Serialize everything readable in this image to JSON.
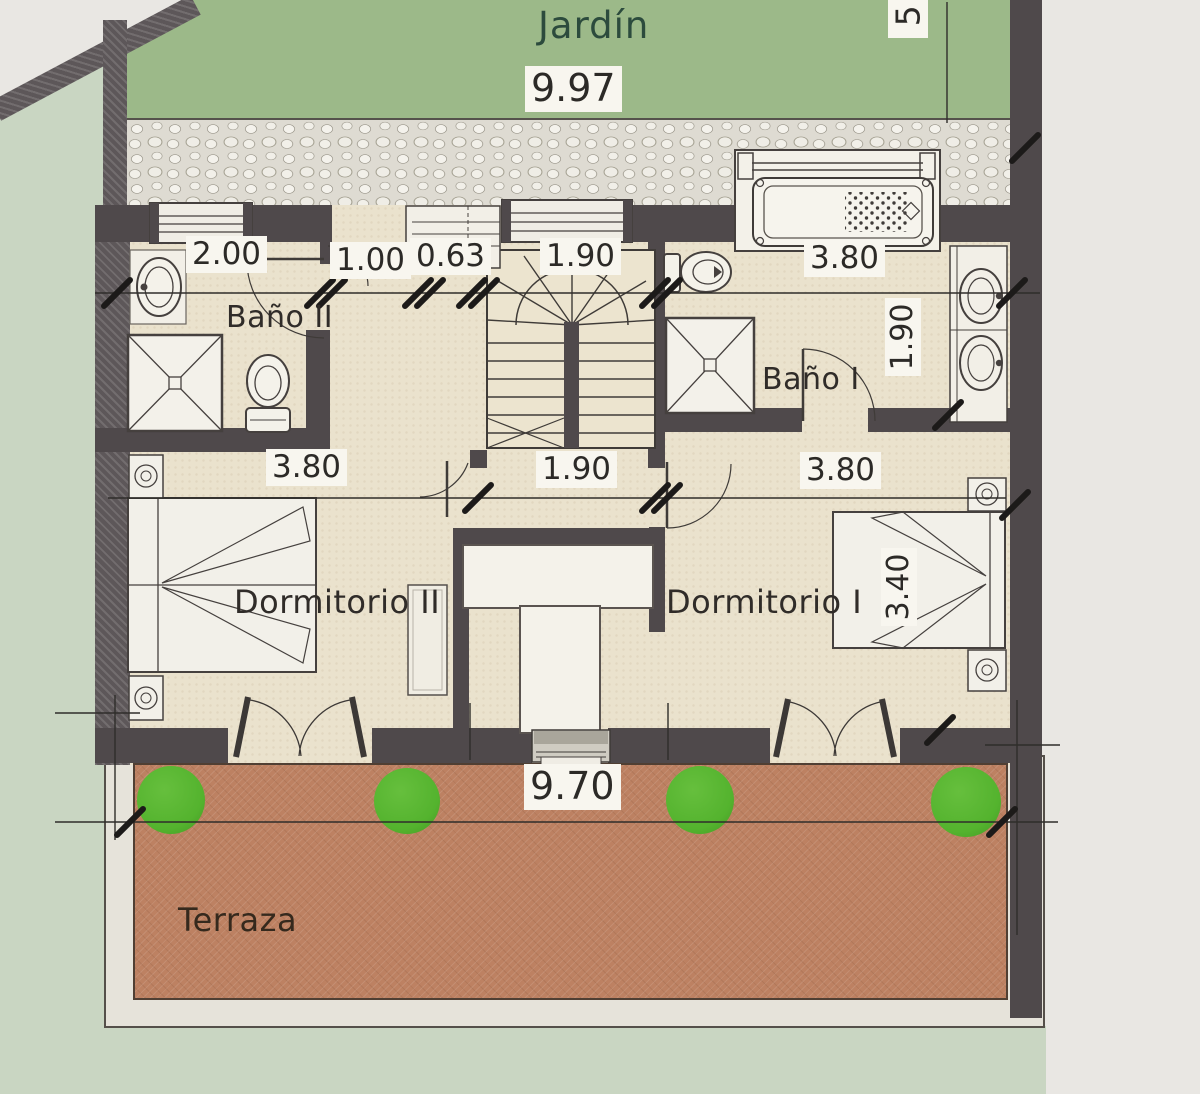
{
  "labels": {
    "garden": "Jardín",
    "bath2": "Baño II",
    "bath1": "Baño I",
    "bedroom2": "Dormitorio II",
    "bedroom1": "Dormitorio I",
    "terrace": "Terraza"
  },
  "dimensions": {
    "garden_width": "9.97",
    "right_partial": "5",
    "bath2_window": "2.00",
    "entry_opening": "1.00",
    "closet": "0.63",
    "stair_window": "1.90",
    "bath1_width": "3.80",
    "bath1_depth": "1.90",
    "bedroom2_width": "3.80",
    "hall_width": "1.90",
    "bedroom1_width": "3.80",
    "bedroom1_depth": "3.40",
    "terrace_width": "9.70"
  },
  "fixtures": [
    "staircase",
    "bathtub",
    "shower",
    "shower",
    "toilet",
    "toilet",
    "washbasin",
    "double-vanity",
    "double-bed",
    "double-bed",
    "nightstand",
    "nightstand",
    "nightstand",
    "nightstand",
    "wardrobe",
    "french-door",
    "french-door",
    "window",
    "window",
    "window",
    "closet",
    "bush",
    "bush",
    "bush",
    "bush"
  ],
  "colors": {
    "paper": "#e9e7e3",
    "plot_green": "#c9d6c2",
    "garden_green": "#9cb989",
    "gravel": "#dedbd2",
    "floor": "#eae2cd",
    "wall": "#4f494b",
    "terrace_floor": "#bd8162",
    "bush": "#54b32e",
    "room_white": "#f2f0e9",
    "chip_bg": "#f8f6ef",
    "ink": "#2c2a27",
    "garden_text": "#2c4b3d"
  }
}
